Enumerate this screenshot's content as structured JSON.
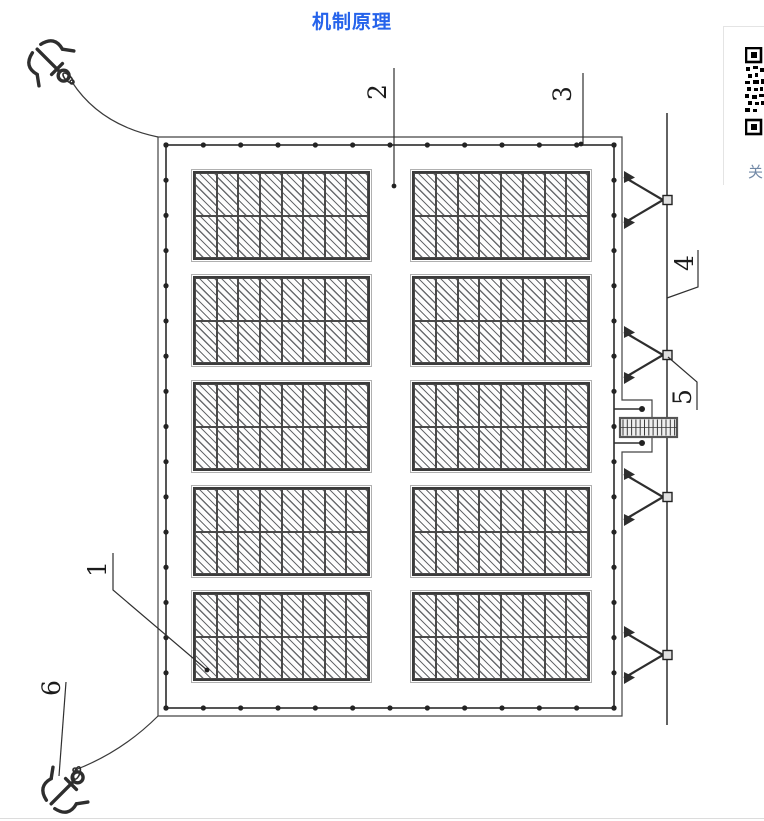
{
  "page": {
    "title": "机制原理",
    "title_color": "#2563eb"
  },
  "diagram": {
    "callouts": [
      "1",
      "2",
      "3",
      "4",
      "5",
      "6"
    ],
    "panel_array": {
      "rows": 5,
      "columns": 2,
      "cell_rows": 2,
      "cell_columns": 8
    },
    "buoys": {
      "top": 13,
      "bottom": 13,
      "left": 17,
      "right": 17,
      "platform_extra": 2
    },
    "bracket_count": 4,
    "anchor_count": 2,
    "line_color": "#2e2e2e"
  },
  "side_widget": {
    "label": "关"
  }
}
